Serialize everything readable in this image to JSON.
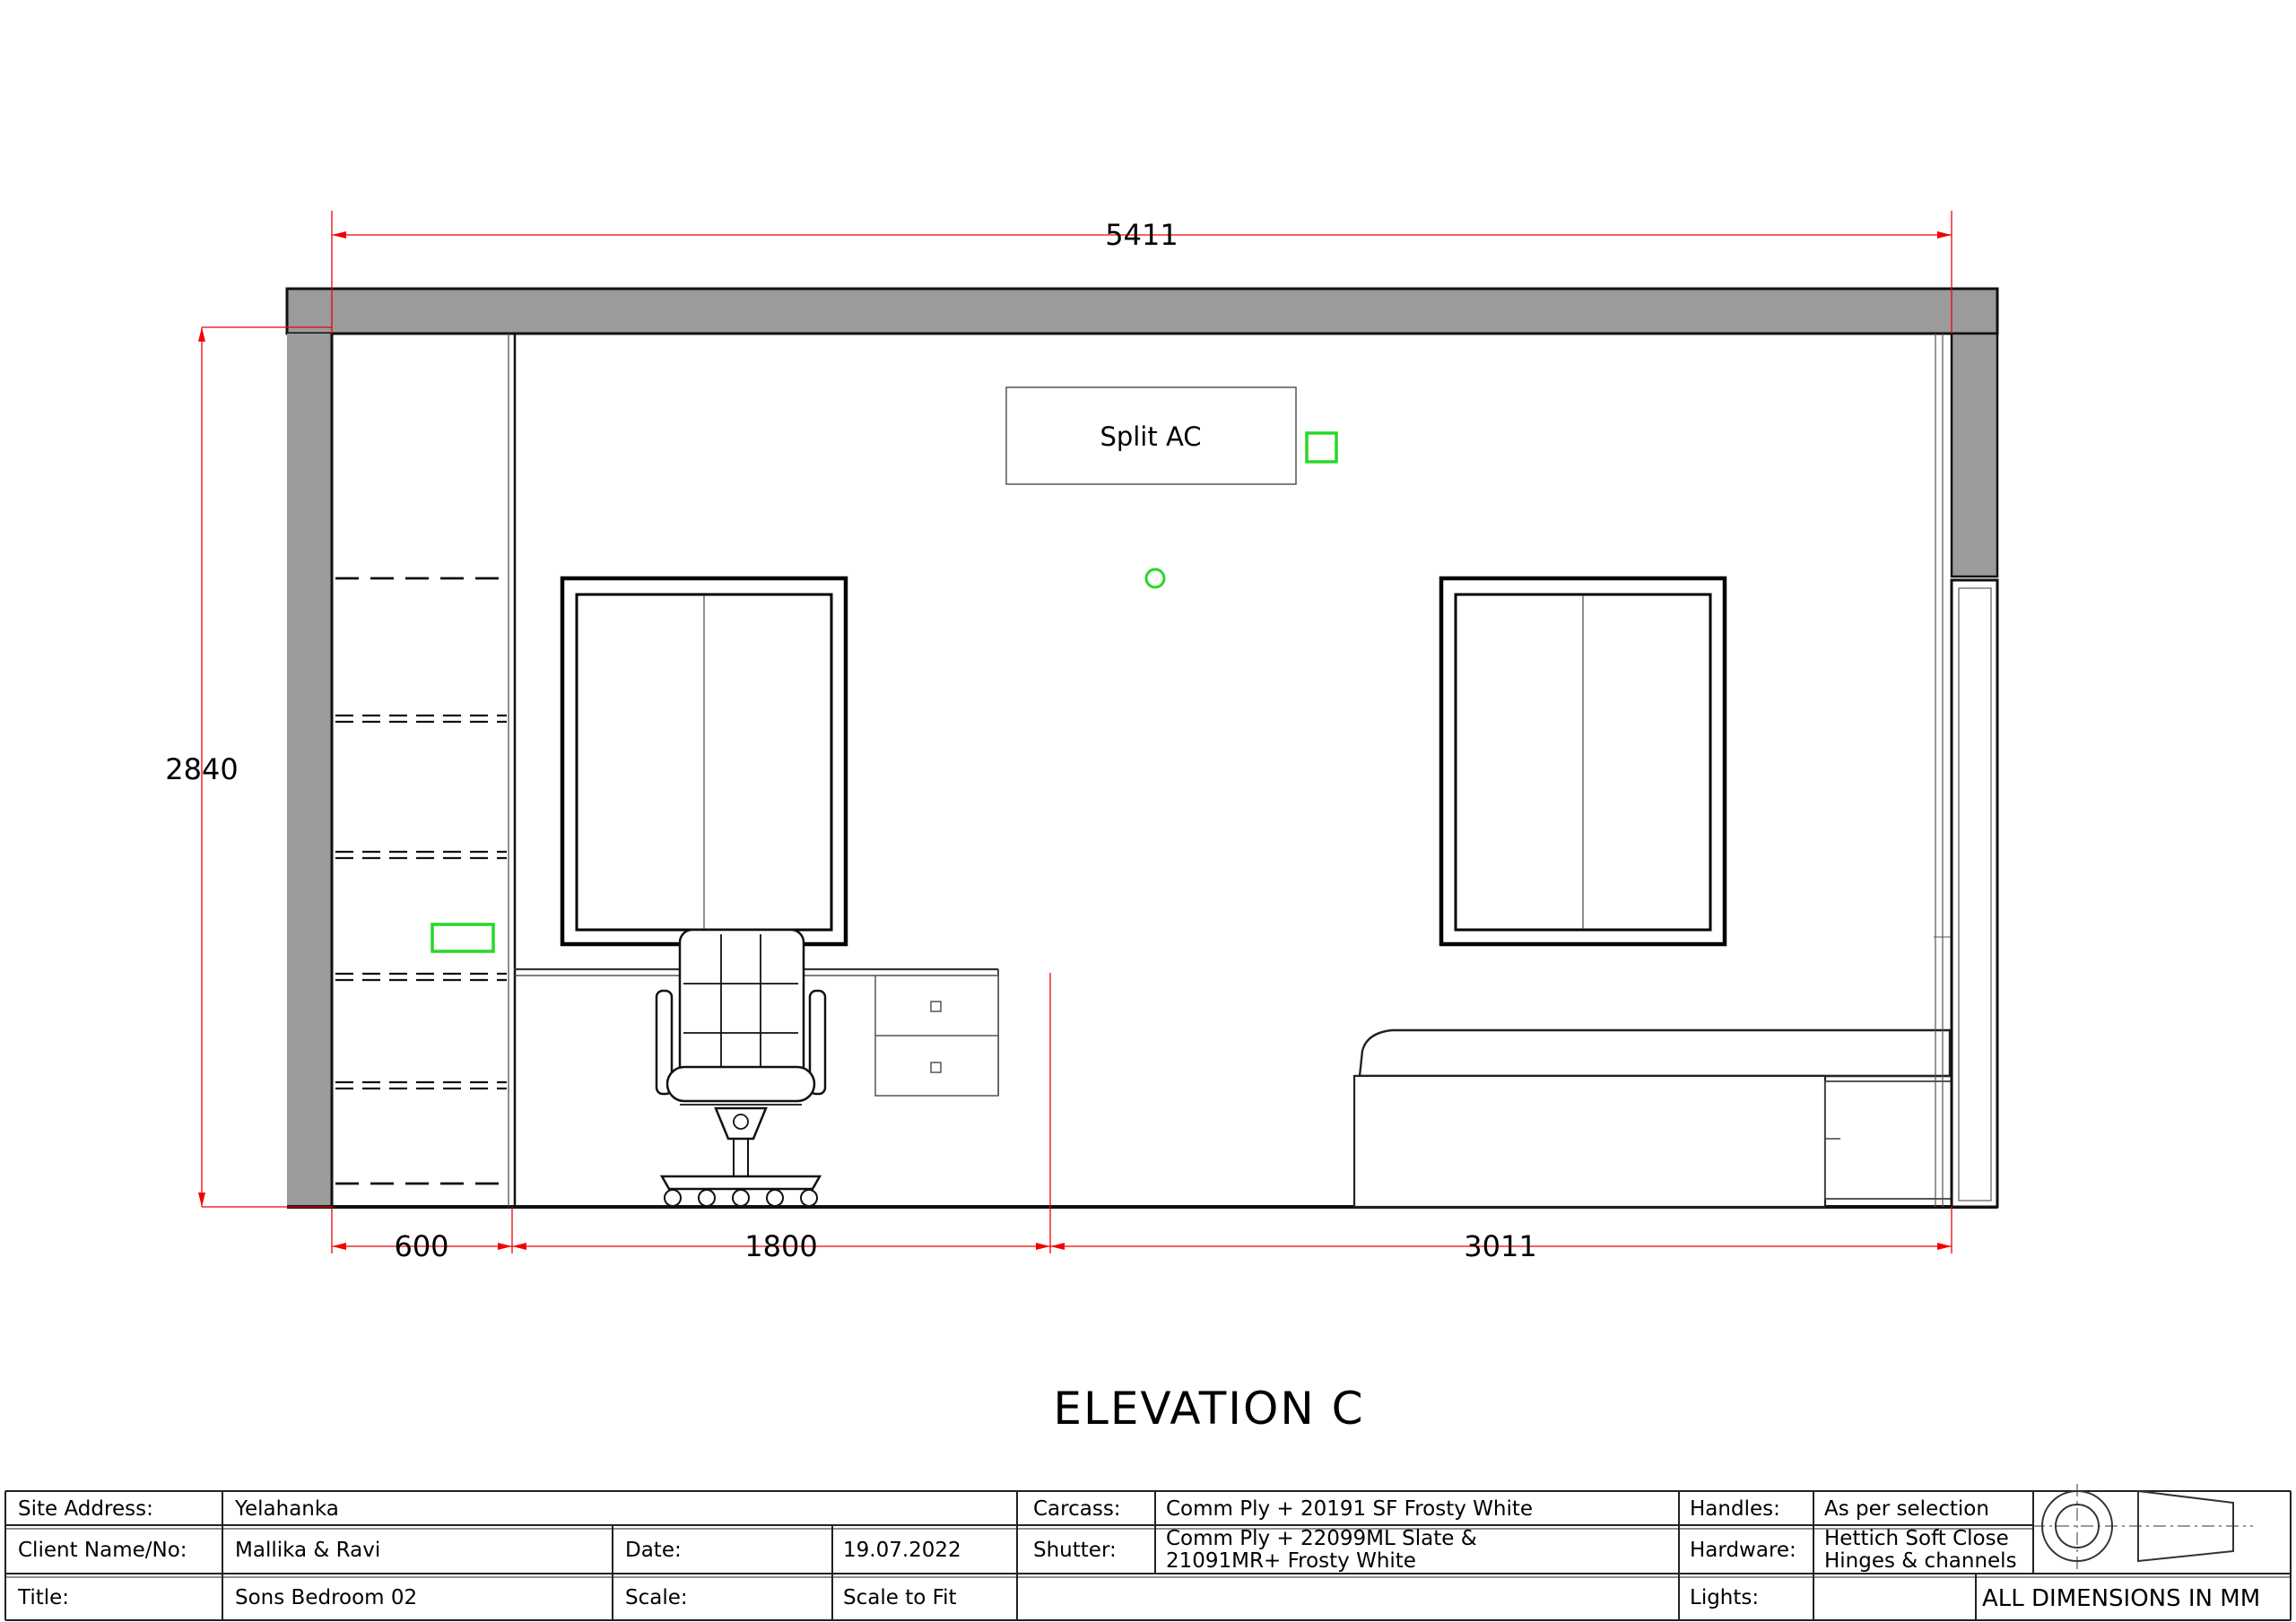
{
  "drawing": {
    "room_label": "Split AC",
    "title": "ELEVATION C",
    "dims": {
      "total_width": "5411",
      "total_height": "2840",
      "left_segment": "600",
      "middle_segment": "1800",
      "right_segment": "3011"
    },
    "colors": {
      "dimension_red": "#f30000",
      "marker_green": "#27d827",
      "wall_gray": "#9b9b9b"
    }
  },
  "title_block": {
    "site_address_label": "Site Address:",
    "site_address_value": "Yelahanka",
    "client_label": "Client Name/No:",
    "client_value": "Mallika & Ravi",
    "date_label": "Date:",
    "date_value": "19.07.2022",
    "title_label": "Title:",
    "title_value": "Sons Bedroom 02",
    "scale_label": "Scale:",
    "scale_value": "Scale to Fit",
    "carcass_label": "Carcass:",
    "carcass_value": "Comm Ply + 20191 SF Frosty White",
    "shutter_label": "Shutter:",
    "shutter_value_line1": "Comm Ply + 22099ML Slate &",
    "shutter_value_line2": "21091MR+ Frosty White",
    "handles_label": "Handles:",
    "handles_value": "As per selection",
    "hardware_label": "Hardware:",
    "hardware_value_line1": "Hettich Soft Close",
    "hardware_value_line2": "Hinges & channels",
    "lights_label": "Lights:",
    "note": "ALL DIMENSIONS IN MM"
  }
}
